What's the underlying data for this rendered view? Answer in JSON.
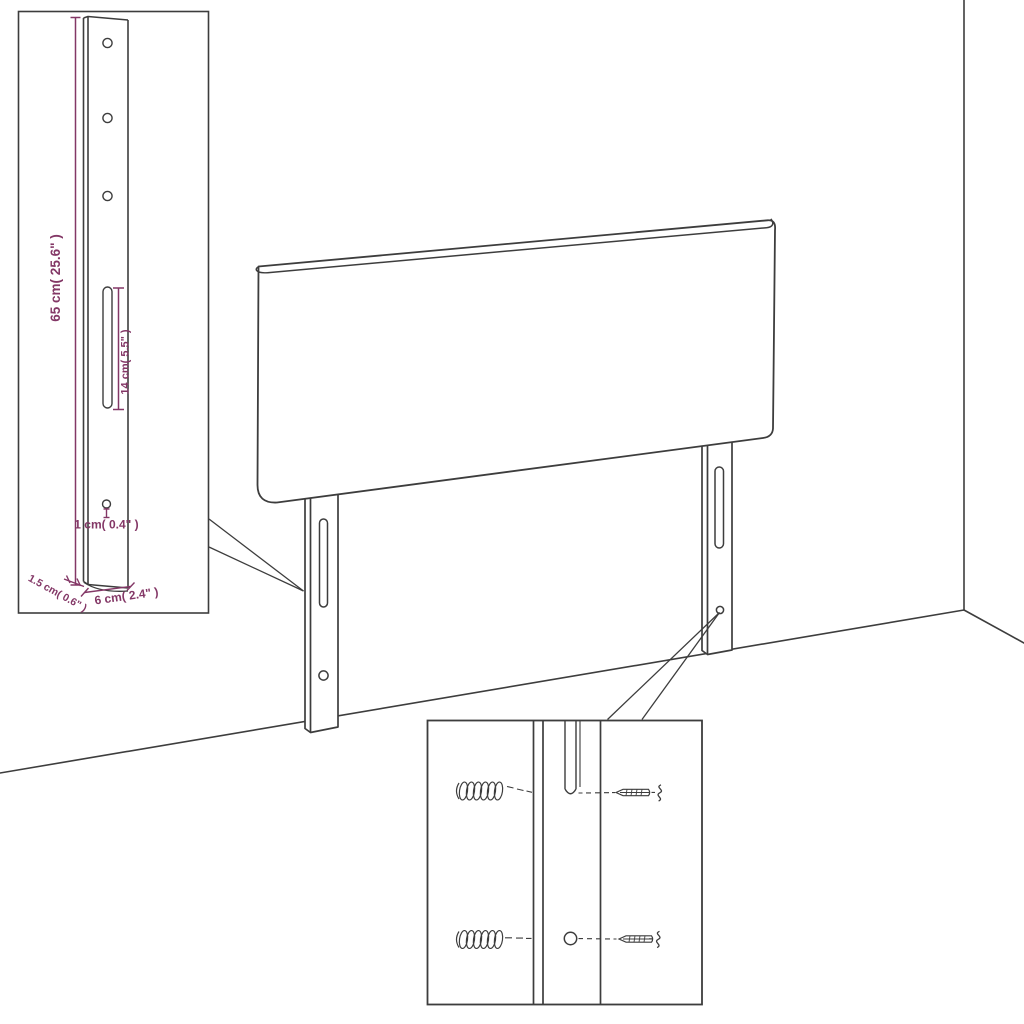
{
  "annotations": {
    "leg_height": "65 cm( 25.6\" )",
    "slot_length": "14 cm( 5.5\" )",
    "hole_diameter": "1 cm( 0.4\" )",
    "side_thickness": "1.5 cm( 0.6\" )",
    "leg_width": "6 cm( 2.4\" )"
  },
  "colors": {
    "line": "#3d3d3d",
    "annotation": "#833766",
    "background": "#ffffff"
  },
  "icons": {
    "wall_plug": "coil-scribble-glyph",
    "screw": "pointed-threaded-screw-glyph",
    "squiggle": "s-curve-continuation-glyph"
  }
}
